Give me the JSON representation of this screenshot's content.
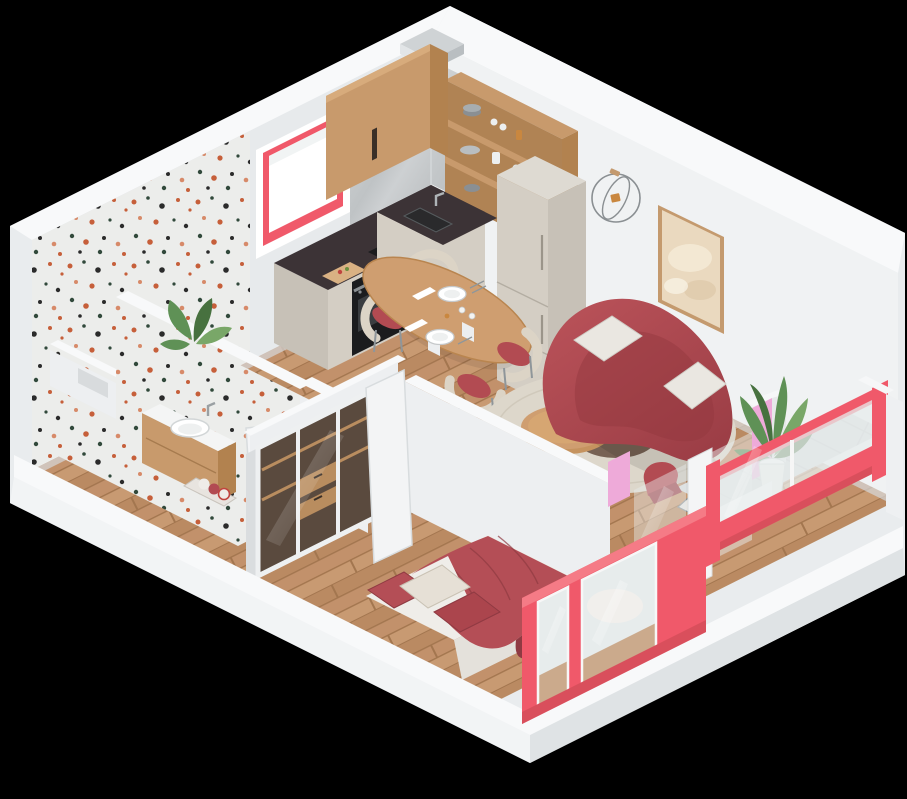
{
  "canvas": {
    "width": 907,
    "height": 799
  },
  "scene": {
    "description": "isometric-3d-studio-apartment-floor-plan-render",
    "rooms": [
      {
        "name": "kitchen",
        "objects": [
          "upper-wood-cabinet",
          "open-wood-shelf",
          "marble-backsplash",
          "induction-cooktop",
          "oven",
          "sink",
          "tall-fridge-cabinet",
          "red-framed-window",
          "cutting-board"
        ]
      },
      {
        "name": "dining",
        "objects": [
          "oval-wood-table",
          "tableware",
          "four-cream-red-chairs"
        ]
      },
      {
        "name": "living",
        "objects": [
          "curved-red-sofa",
          "white-pillows",
          "round-coffee-table",
          "dried-plant-vase",
          "beige-rug",
          "abstract-wall-art",
          "wire-wall-clock"
        ]
      },
      {
        "name": "bathroom",
        "objects": [
          "terrazzo-walls",
          "terrazzo-floor",
          "wood-vanity",
          "white-basin",
          "shower-niche",
          "towel-basket",
          "open-door"
        ]
      },
      {
        "name": "bedroom",
        "objects": [
          "double-bed",
          "red-duvet",
          "red-and-cream-pillows",
          "glass-door-wardrobe",
          "coral-framed-window",
          "open-door"
        ]
      },
      {
        "name": "balcony",
        "objects": [
          "tile-floor",
          "coral-glass-balustrade",
          "pink-accent-panel",
          "palm-plant-white-pot",
          "magazine-rack",
          "red-chair",
          "glass-door"
        ]
      }
    ]
  },
  "palette": {
    "background": "#000000",
    "shell": "#e9ecee",
    "shell_light": "#f2f4f5",
    "shell_shade": "#dfe3e5",
    "wall_top": "#f8f9fa",
    "wall_nw": "#e7eaec",
    "wall_ne": "#f0f2f3",
    "wall_partition": "#edeff1",
    "wall_side": "#dadddf",
    "ao": "#d5d9db",
    "floor_wood": "#c2916b",
    "wood_plank_a": "#ba8a62",
    "wood_plank_b": "#c89a72",
    "wood_seam": "#a3764f",
    "terrazzo_base": "#ecedeb",
    "terrazzo_orange": "#c65f3a",
    "terrazzo_green": "#31493b",
    "terrazzo_black": "#2b2b2b",
    "terrazzo_pink": "#d78a69",
    "tile": "#d8dbdc",
    "tile_grout": "#c6cacc",
    "marble": "#c6c9cb",
    "marble_light": "#dcdfe0",
    "counter_dark": "#3c3336",
    "cabinet_wood": "#c89a6c",
    "cabinet_wood_dark": "#b2824f",
    "cabinet_beige": "#d4cec4",
    "beige_dark": "#c7c1b7",
    "beige_top": "#dedad2",
    "appliance_black": "#1b1c1e",
    "appliance_glass": "#3a3d40",
    "sofa_red": "#b24b52",
    "sofa_red_dark": "#92383f",
    "bed_red": "#b44e56",
    "bed_red_dark": "#8f3a42",
    "coral": "#f0596a",
    "coral_dark": "#d94f5c",
    "coral_light": "#f57b86",
    "pink": "#eeaad9",
    "rug": "#ddd7cb",
    "mat_brown": "#6b5547",
    "pillow_white": "#eae7e1",
    "sheet_white": "#efede9",
    "plant_green": "#5f9156",
    "plant_green_dark": "#47713f",
    "plant_green_light": "#79a768",
    "metal": "#9aa0a3",
    "glass": "#e7ecec",
    "white": "#ffffff",
    "art_cream": "#ead9bf",
    "frame_wood": "#c49a6e",
    "table_wood": "#cf9e70",
    "chair_cream": "#dcd4c6",
    "amber": "#c9873f"
  }
}
